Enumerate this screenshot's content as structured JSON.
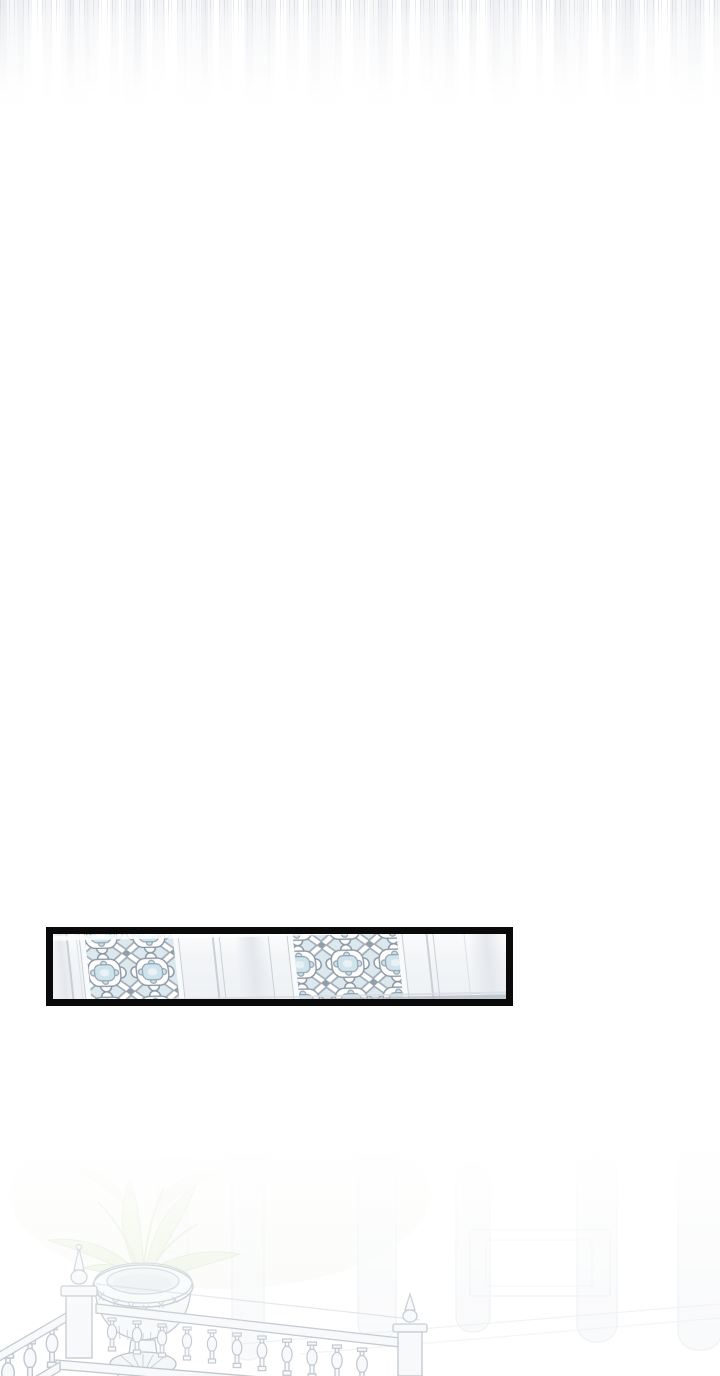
{
  "page": {
    "kind": "webtoon-scroll-segment",
    "background_color": "#ffffff"
  },
  "top_fade": {
    "description": "vertical streaks of previous panel fading out",
    "streak_dark": "#cdd0d6",
    "streak_light": "#eef0f3"
  },
  "framed_panel": {
    "description": "close-up of palace wall with ornate lattice screens",
    "frame_color": "#0a0a0a",
    "wall_color": "#f3f5f7",
    "panel_line_color": "#c3c9d0",
    "molding_color": "#f8fafb",
    "lattice_background": "#dce8ee",
    "lattice_ribbon_white": "#ffffff",
    "lattice_outline": "#8895a1",
    "lattice_blue": "#cfe3ec",
    "lattice_inner_highlight": "#e9f1f5",
    "corner_diamond": "#929fab",
    "base_strip_color": "#b7bec6"
  },
  "bottom_scene": {
    "description": "faint balcony balustrade with urn planter, plant and columns fading in",
    "stroke_color": "#b9c1c9",
    "fill_color": "#f6f8f9",
    "background_stroke": "#dfe5e9",
    "background_fill": "#f4f6f7",
    "leaf_fill": "#e9f0dd",
    "leaf_stroke": "#d5e0c6",
    "wash_green": "#eef3e6"
  }
}
